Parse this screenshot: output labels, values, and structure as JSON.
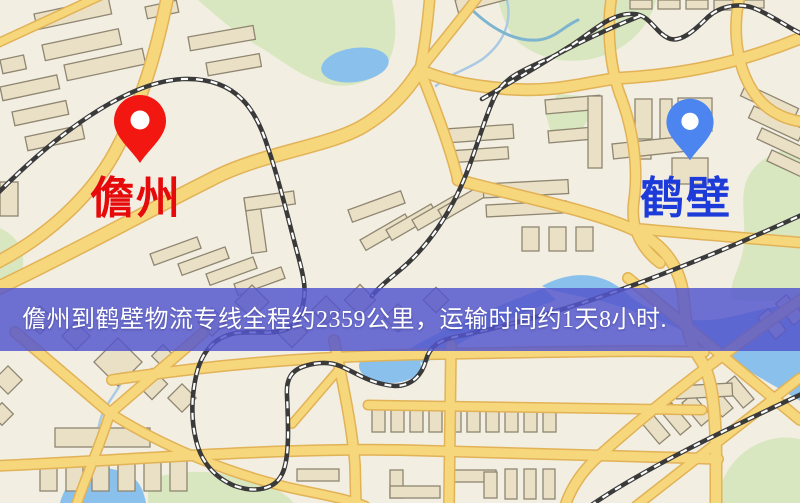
{
  "map": {
    "origin": {
      "label": "儋州",
      "pin_color": "#f21710",
      "pin_hole_color": "#ffffff",
      "label_color": "#e60a0a",
      "icon": "map-pin-icon"
    },
    "destination": {
      "label": "鹤壁",
      "pin_color": "#4c85ef",
      "pin_hole_color": "#ffffff",
      "label_color": "#1d3bd8",
      "icon": "map-pin-icon"
    },
    "banner": {
      "text": "儋州到鹤壁物流专线全程约2359公里，运输时间约1天8小时."
    }
  },
  "theme": {
    "bg": "#f2eee2",
    "park": "#d8e7bf",
    "water": "#8ac1ec",
    "road_fill": "#f6d77b",
    "road_casing": "#e2b257",
    "building_fill": "#eae0c5",
    "building_stroke": "#8f8672",
    "rail_dark": "#3a3a3a",
    "rail_light": "#ffffff",
    "stream": "#a9c9e4",
    "stream_teal": "#7db4cf",
    "banner_bg": "#5356cd",
    "banner_text": "#ffffff"
  }
}
